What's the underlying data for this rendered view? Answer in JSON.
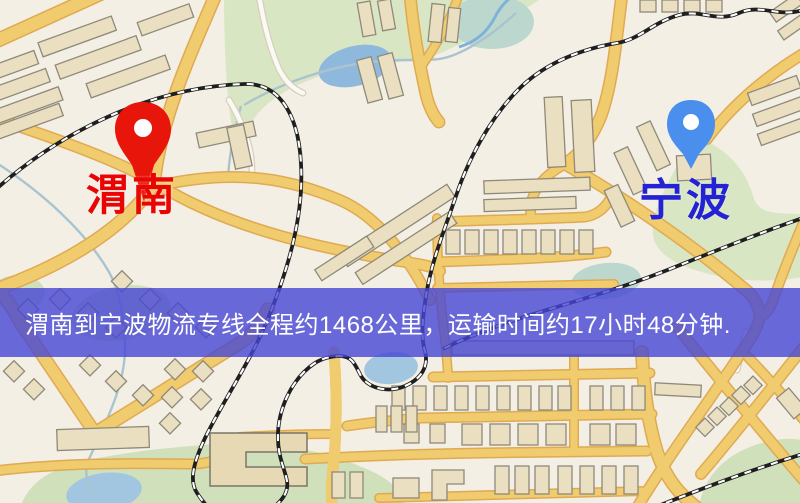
{
  "map": {
    "origin": {
      "label": "渭南",
      "marker": "red-map-pin-icon"
    },
    "destination": {
      "label": "宁波",
      "marker": "blue-map-pin-icon"
    },
    "banner": {
      "text": "渭南到宁波物流专线全程约1468公里，运输时间约17小时48分钟."
    },
    "colors": {
      "background": "#f4efe5",
      "park": "#d9e6c4",
      "water": "#8fb9dc",
      "road": "#f0cc6e",
      "road_casing": "#dfaa52",
      "building": "#eadfc0",
      "building_outline": "#8f897a",
      "railway": "#1f1f1f",
      "origin_pin": "#e8150a",
      "origin_label": "#ea0505",
      "destination_pin": "#4a8fee",
      "destination_label": "#2323d3",
      "banner_bg": "rgba(70,70,212,0.8)",
      "banner_text": "#ffffff"
    }
  }
}
